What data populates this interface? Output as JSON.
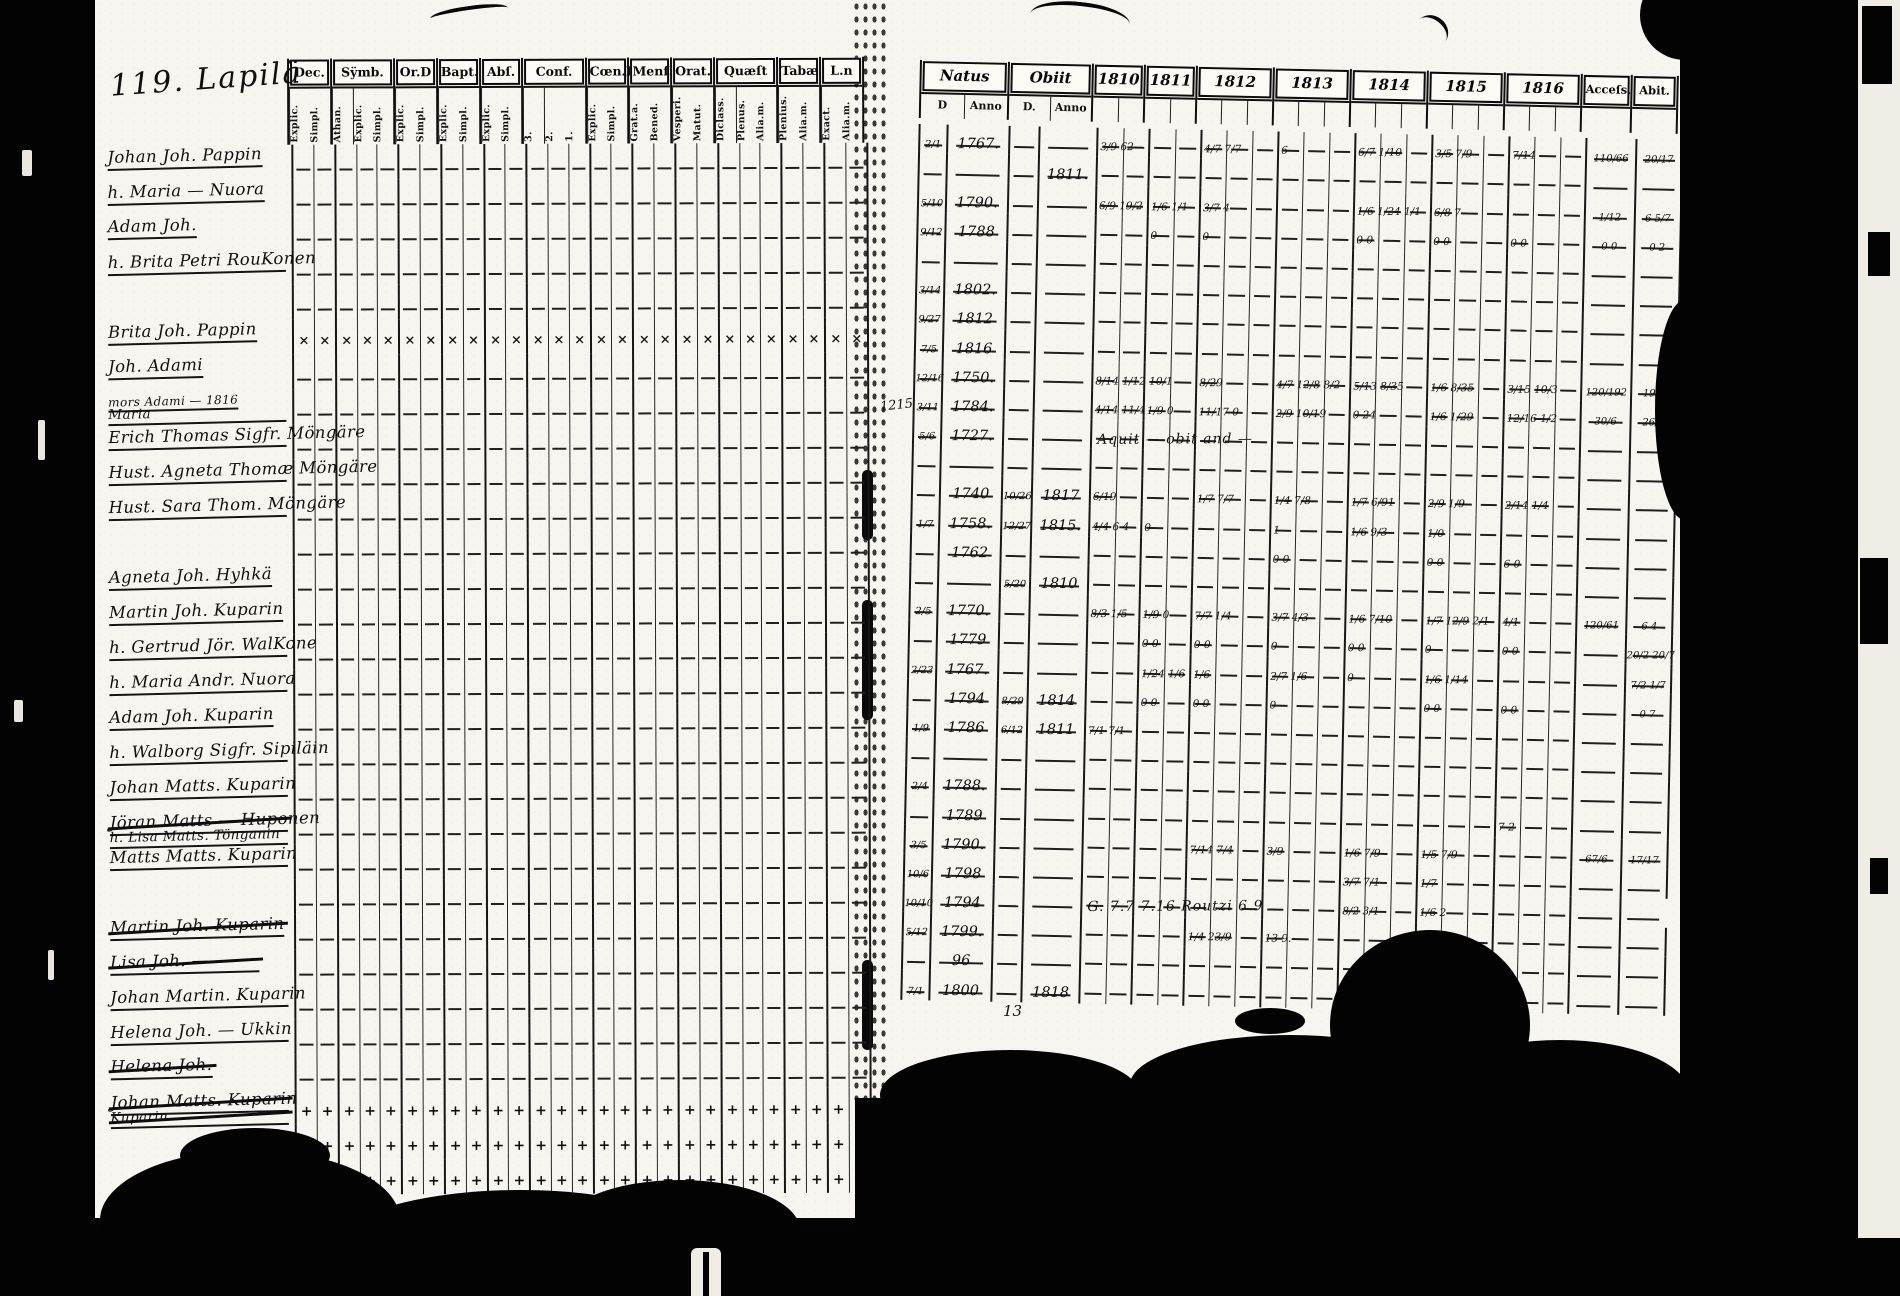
{
  "page": {
    "title": "119. Lapilä",
    "gutter_note": "1215",
    "bottom_note": "13",
    "bottom_left_note": "Mande"
  },
  "left_table": {
    "groups": [
      {
        "label": "Dec.",
        "subs": [
          "Explic.",
          "Simpl."
        ]
      },
      {
        "label": "Sÿmb.",
        "subs": [
          "Athan.",
          "Explic.",
          "Simpl."
        ]
      },
      {
        "label": "Or.D",
        "subs": [
          "Explic.",
          "Simpl."
        ]
      },
      {
        "label": "Bapt.",
        "subs": [
          "Explic.",
          "Simpl."
        ]
      },
      {
        "label": "Abſ.",
        "subs": [
          "Explic.",
          "Simpl."
        ]
      },
      {
        "label": "Conf.",
        "subs": [
          "3.",
          "2.",
          "1."
        ]
      },
      {
        "label": "Cœn.D",
        "subs": [
          "Explic.",
          "Simpl."
        ]
      },
      {
        "label": "Menſ.",
        "subs": [
          "Grat.a.",
          "Bened."
        ]
      },
      {
        "label": "Orat.",
        "subs": [
          "Vesperi.",
          "Matut."
        ]
      },
      {
        "label": "Quæſt",
        "subs": [
          "Diclass.",
          "Plenus.",
          "Alia.m."
        ]
      },
      {
        "label": "Tabæ",
        "subs": [
          "Plenius.",
          "Alia.m."
        ]
      },
      {
        "label": "L.n",
        "subs": [
          "Exact.",
          "Alia.m."
        ]
      }
    ]
  },
  "right_table": {
    "natus": {
      "label": "Natus",
      "subs": [
        "D",
        "Anno"
      ]
    },
    "obiit": {
      "label": "Obiit",
      "subs": [
        "D.",
        "Anno"
      ]
    },
    "years": [
      {
        "label": "1810",
        "cols": 2
      },
      {
        "label": "1811",
        "cols": 2
      },
      {
        "label": "1812",
        "cols": 3
      },
      {
        "label": "1813",
        "cols": 3
      },
      {
        "label": "1814",
        "cols": 3
      },
      {
        "label": "1815",
        "cols": 3
      },
      {
        "label": "1816",
        "cols": 3
      }
    ],
    "access_label": "Acceſs.",
    "abiit_label": "Abit."
  },
  "rows": [
    {
      "name": "Johan Joh. Pappin",
      "nd": "2/1",
      "na": "1767.",
      "y": {
        "1810": "3/9 62",
        "1812": "4/7 7/7",
        "1813": "6",
        "1814": "6/7 1/10",
        "1815": "3/5 7/9",
        "1816": "7/14"
      },
      "acc": "110/66",
      "ab": "20/17"
    },
    {
      "name": "h. Maria — Nuora",
      "oa": "1811."
    },
    {
      "name": "Adam Joh.",
      "nd": "5/10",
      "na": "1790.",
      "y": {
        "1810": "6/9 19/2",
        "1811": "1/6 1/1",
        "1812": "3/7 4",
        "1814": "1/6 1/24 1/1",
        "1815": "6/8 7"
      },
      "acc": "1/12",
      "ab": "6 5/7"
    },
    {
      "name": "h. Brita Petri RouKonen",
      "nd": "9/12",
      "na": "1788",
      "y": {
        "1811": "0",
        "1812": "0",
        "1814": "0 0",
        "1815": "0 0",
        "1816": "0 0"
      },
      "acc": "0 0",
      "ab": "0 2"
    },
    {},
    {
      "name": "Brita Joh. Pappin",
      "xm": true,
      "nd": "3/14",
      "na": "1802."
    },
    {
      "name": "Joh. Adami",
      "nd": "9/27",
      "na": "1812"
    },
    {
      "name": "mors Adami — 1816",
      "small": true,
      "name2": "Maria",
      "nd": "7/5",
      "na": "1816"
    },
    {
      "name": "Erich Thomas Sigfr. Möngäre",
      "nd": "12/16",
      "na": "1750.",
      "y": {
        "1810": "8/14 1/12 10/1",
        "1812": "8/29",
        "1813": "4/7 12/8 8/2",
        "1814": "5/13 8/35",
        "1815": "1/6 8/35",
        "1816": "3/15 10/3"
      },
      "acc": "120/192",
      "ab": "19/9"
    },
    {
      "name": "Hust. Agneta Thomæ Möngäre",
      "nd": "3/11",
      "na": "1784.",
      "y": {
        "1810": "4/14 11/4",
        "1811": "1/9 0",
        "1812": "11/17 0",
        "1813": "2/9 10/19",
        "1814": "0 24",
        "1815": "1/6 1/29",
        "1816": "12/16 1/2"
      },
      "acc": "30/6",
      "ab": "26/4"
    },
    {
      "name": "Hust. Sara Thom. Möngäre",
      "nd": "5/6",
      "na": "1727.",
      "scrawl": "Aquit — obit and —"
    },
    {},
    {
      "name": "Agneta Joh. Hyhkä",
      "na": "1740",
      "od": "10/26",
      "oa": "1817",
      "y": {
        "1810": "6/19",
        "1812": "1/7 7/7",
        "1813": "1/4 7/8",
        "1814": "1/7 6/91",
        "1815": "2/9 1/9",
        "1816": "2/14 1/4"
      }
    },
    {
      "name": "Martin Joh. Kuparin",
      "nd": "1/7",
      "na": "1758.",
      "od": "12/27",
      "oa": "1815.",
      "y": {
        "1810": "4/4 6 4",
        "1811": "0",
        "1813": "1",
        "1814": "1/6 9/3",
        "1815": "1/0"
      }
    },
    {
      "name": "h. Gertrud Jör. WalKone",
      "na": "1762",
      "y": {
        "1813": "0 0",
        "1815": "0 0",
        "1816": "6 0"
      }
    },
    {
      "name": "h. Maria Andr. Nuora",
      "od": "5/20",
      "oa": "1810"
    },
    {
      "name": "Adam Joh. Kuparin",
      "nd": "2/5",
      "na": "1770.",
      "y": {
        "1810": "8/3 1/5",
        "1811": "1/9 0",
        "1812": "7/7 1/4",
        "1813": "3/7 4/3",
        "1814": "1/6 7/10",
        "1815": "1/7 12/9 2/1",
        "1816": "4/1"
      },
      "acc": "120/61",
      "ab": "6 4"
    },
    {
      "name": "h. Walborg Sigfr. Sipiläin",
      "na": "1779",
      "y": {
        "1811": "0 0",
        "1812": "0 0",
        "1813": "0",
        "1814": "0 0",
        "1815": "0",
        "1816": "0 0"
      },
      "ab": "20/2 20/7"
    },
    {
      "name": "Johan Matts. Kuparin",
      "nd": "2/23",
      "na": "1767.",
      "y": {
        "1811": "1/24 1/6",
        "1812": "1/6",
        "1813": "2/7 1/6",
        "1814": "0",
        "1815": "1/6 1/14"
      },
      "ab": "7/2 1/7"
    },
    {
      "name": "Jöran Matts — Huponen",
      "st": true,
      "name2": "h. Lisa Matts. Tönganin",
      "na": "1794",
      "od": "8/29",
      "oa": "1814",
      "y": {
        "1811": "0 0",
        "1812": "0 0",
        "1813": "0",
        "1815": "0 0",
        "1816": "0 0"
      },
      "ab": "0 7"
    },
    {
      "name": "Matts Matts. Kuparin",
      "nd": "1/9",
      "na": "1786",
      "od": "6/12",
      "oa": "1811",
      "y": {
        "1810": "7/1 7/1"
      }
    },
    {},
    {
      "name": "Martin Joh. Kuparin",
      "st": true,
      "nd": "2/4",
      "na": "1788."
    },
    {
      "name": "Lisa Joh. ————",
      "st": true,
      "na": "1789",
      "y": {
        "1816": "7 2"
      }
    },
    {
      "name": "Johan Martin. Kuparin",
      "nd": "3/5",
      "na": "1790.",
      "y": {
        "1812": "7/14 7/4",
        "1813": "3/9",
        "1814": "1/6 7/9",
        "1815": "1/5 7/9"
      },
      "acc": "67/6",
      "ab": "17/17"
    },
    {
      "name": "Helena Joh. — Ukkin",
      "nd": "10/6",
      "na": "1798",
      "y": {
        "1814": "3/7 7/1",
        "1815": "1/7"
      }
    },
    {
      "name": "Helena Joh.",
      "st": true,
      "nd": "10/10",
      "na": "1794",
      "scrawl": "G. 7.7 7.16 Routzi 6.9",
      "y": {
        "1814": "8/2 3/1",
        "1815": "1/6 2"
      }
    },
    {
      "name": "Johan Matts. Kuparin",
      "st": true,
      "name2": "Kuparin",
      "st2": true,
      "pm": true,
      "nd": "5/12",
      "na": "1799.",
      "y": {
        "1812": "1/4 23/9",
        "1813": "13 9."
      }
    },
    {
      "pm": true,
      "na": "96"
    },
    {
      "pm": true,
      "nd": "7/1",
      "na": "1800",
      "oa": "1818"
    }
  ]
}
